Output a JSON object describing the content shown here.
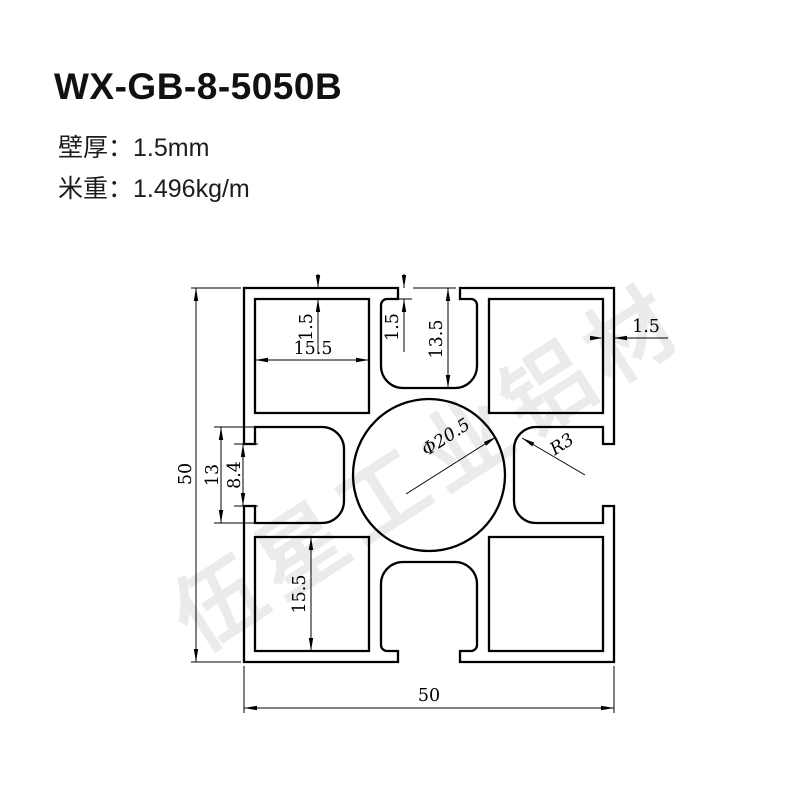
{
  "header": {
    "model": "WX-GB-8-5050B",
    "specs": [
      {
        "label": "壁厚：",
        "value": "1.5mm"
      },
      {
        "label": "米重：",
        "value": "1.496kg/m"
      }
    ]
  },
  "watermark": {
    "text": "伍星工业铝材",
    "color": "#ebebeb"
  },
  "drawing": {
    "line_color": "#000000",
    "dims": {
      "overall_height": "50",
      "overall_width": "50",
      "slot_groove_width": "13",
      "slot_opening": "8.4",
      "cavity_width_top": "15.5",
      "cavity_height_bottom": "15.5",
      "wall_top": "1.5",
      "slot_lip": "1.5",
      "slot_depth": "13.5",
      "wall_right": "1.5",
      "center_hole_dia": "Φ20.5",
      "slot_corner_radius": "R3"
    }
  }
}
